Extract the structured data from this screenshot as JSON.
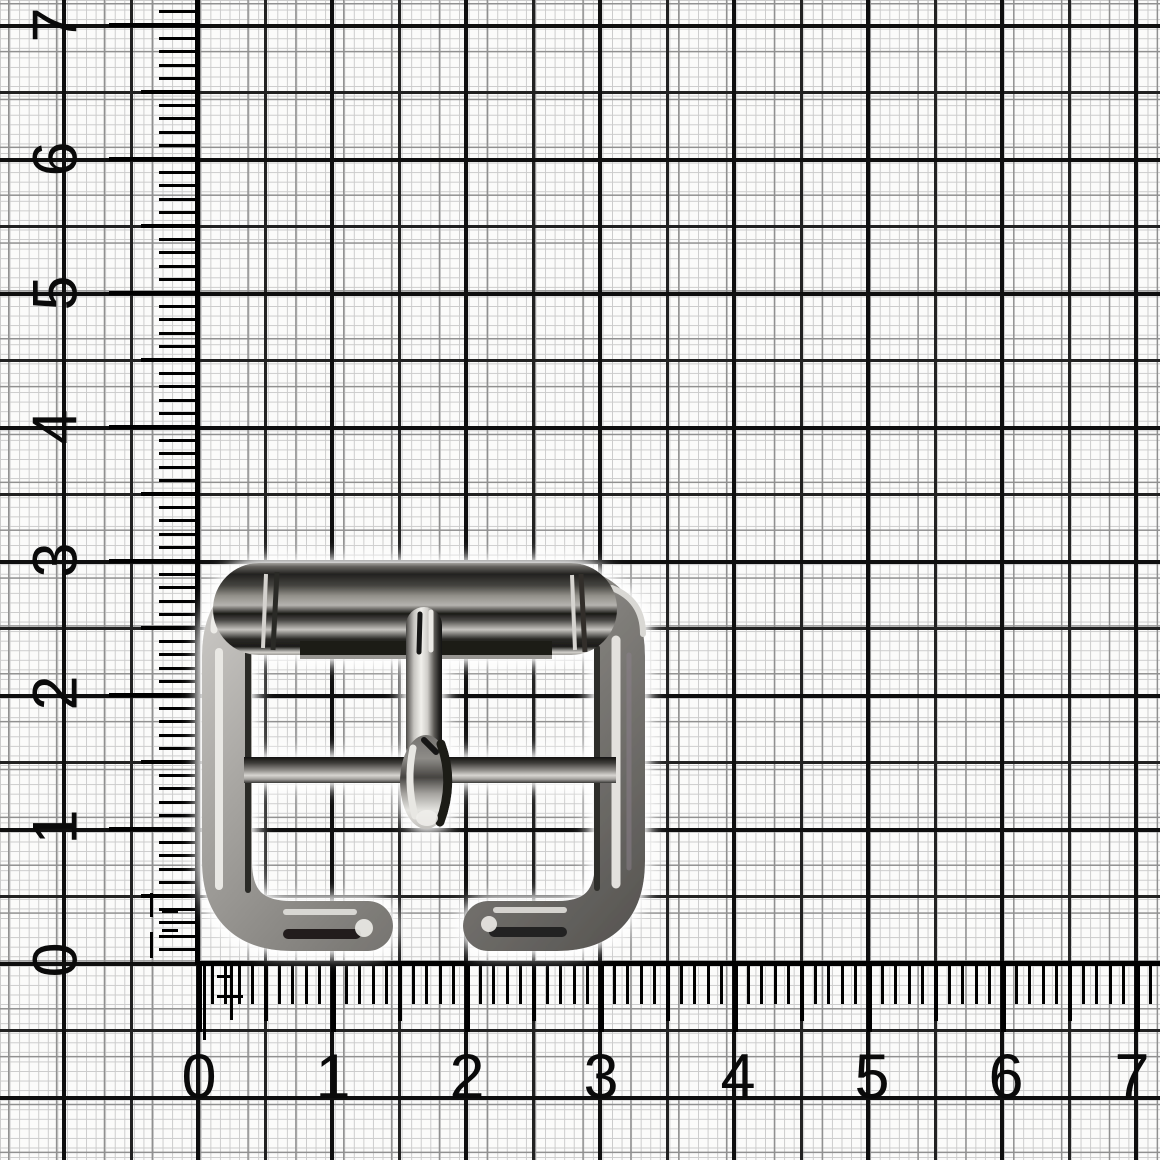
{
  "scene": {
    "description": "Polished nickel roller buckle photographed on millimeter graph paper with measuring rulers",
    "unit_px": 134
  },
  "grid": {
    "background": "#fbfbfa",
    "fine_line": "#cbcbcb",
    "medium_line": "#909090",
    "half_unit_line": "#222222",
    "unit_line": "#0f0f0f"
  },
  "rulers": {
    "color": "#000000",
    "left": {
      "labels": [
        "7",
        "6",
        "5",
        "4",
        "3",
        "2",
        "1",
        "0"
      ]
    },
    "bottom": {
      "labels": [
        "0",
        "1",
        "2",
        "3",
        "4",
        "5",
        "6",
        "7"
      ]
    }
  },
  "buckle": {
    "name": "chrome-roller-buckle",
    "finish": "polished nickel",
    "highlight_color": "#f1f0ec",
    "midtone_color": "#9a9894",
    "shadow_color": "#161514"
  }
}
